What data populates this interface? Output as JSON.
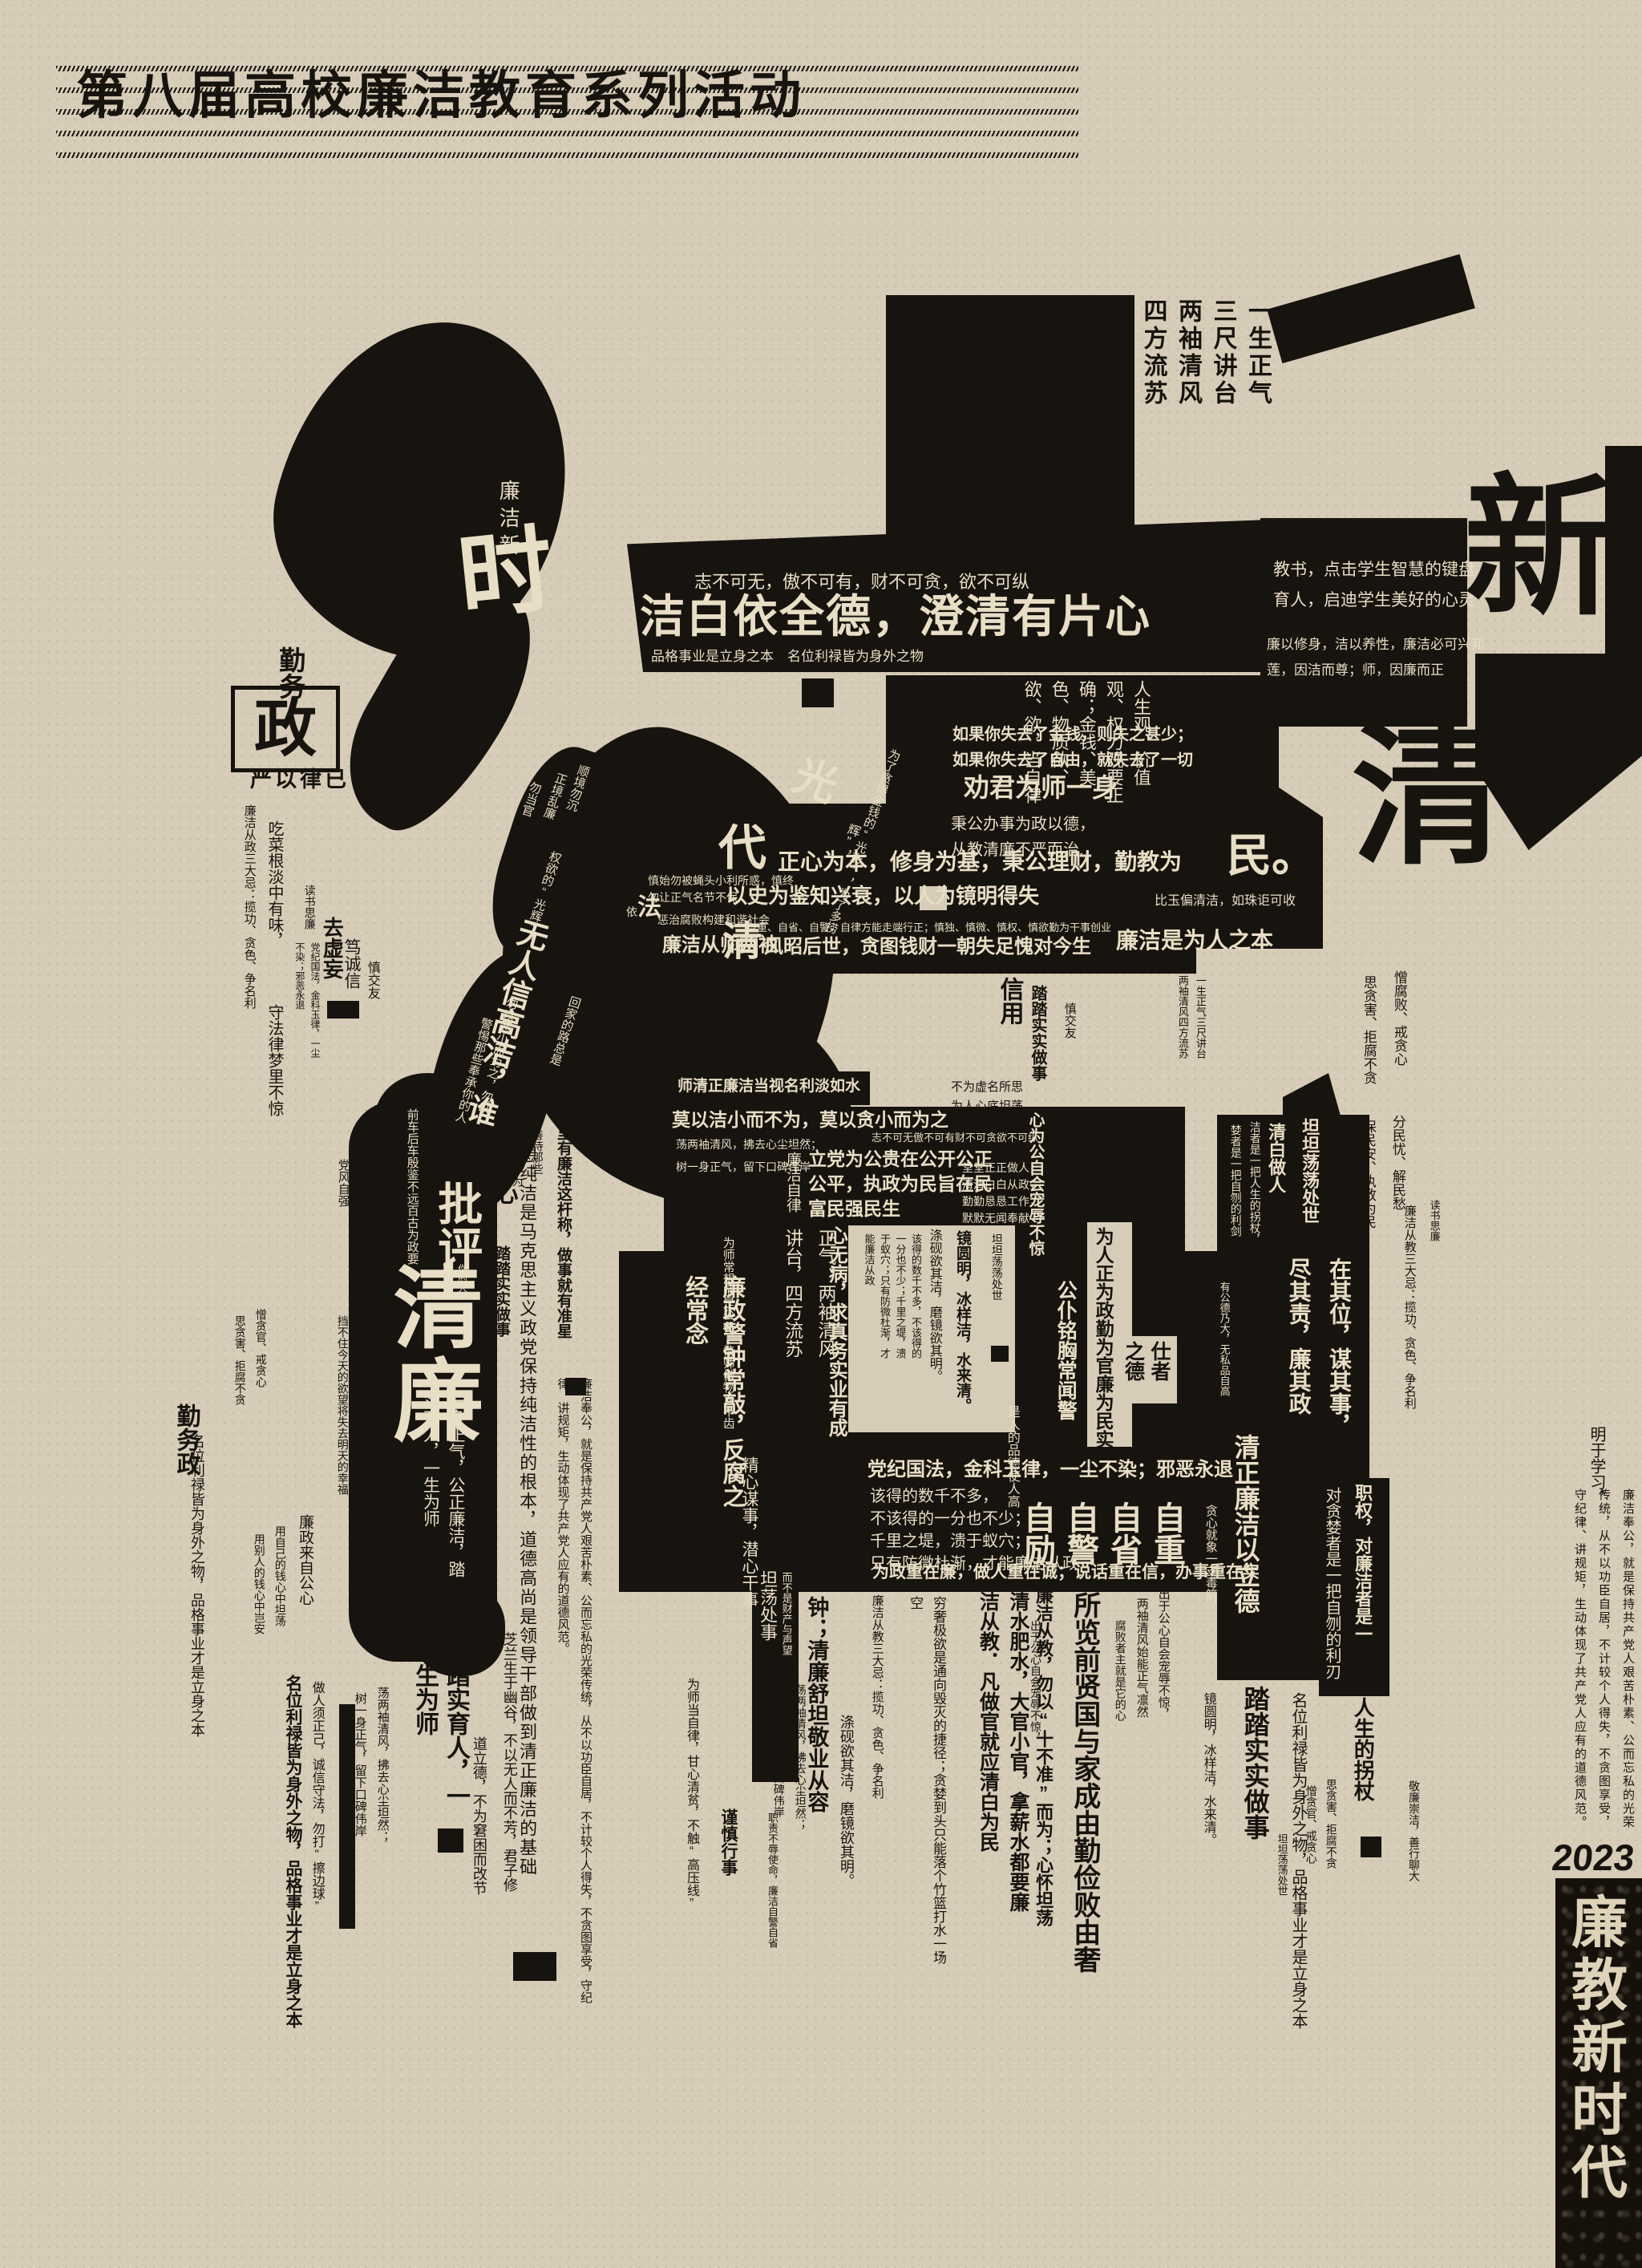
{
  "palette": {
    "paper": "#d6ccb7",
    "ink": "#17130e",
    "cream": "#e8dec5"
  },
  "title": "第八届高校廉洁教育系列活动",
  "banner": {
    "year": "2023",
    "slogan": "廉教新时代"
  },
  "texts": {
    "lianjiexin": "廉洁新",
    "shi_char": "时",
    "qinwu": "勤务",
    "zheng_char": "政",
    "yanyi": "严以律已",
    "sandaji_zheng": "廉洁从政三大忌：揽功、贪色、争名利",
    "chicai": "吃菜根淡中有味，",
    "shoufa": "守法律梦里不惊",
    "dushu": "读书思廉",
    "dangji_guofa": "党纪国法，金科玉律，一尘不染；邪恶永退",
    "quxuwang": "去虚妄",
    "duchengxin": "笃诚信",
    "shenjiaoyou": "慎交友",
    "cross_cols": "一生正气三尺讲台两袖清风四方流苏",
    "zhibuke": "志不可无，傲不可有，财不可贪，欲不可纵",
    "jiebai": "洁白依全德，澄清有片心",
    "pinge": "品格事业是立身之本　名位利禄皆为身外之物",
    "jiaoshu": "教书，点击学生智慧的键盘\n育人，启迪学生美好的心灵",
    "lianyi": "廉以修身，洁以养性，廉洁必可兴邦\n莲，因洁而尊；师，因廉而正",
    "xin_char": "新",
    "sanguan": "人生观、价值观、权力观要正确；金钱、美色、物质欲、欲、欲，当自律",
    "shiqu": "如果你失去了金钱，则失之甚少；\n如果你失去了自由，就失去了一切",
    "quanjun": "劝君为师一身",
    "binggong": "秉公办事为政以德，\n从教清廉不严而治.",
    "qing_big": "清",
    "dai_char": "代",
    "shenshi": "慎始勿被蝇头小利所惑，慎终\n勿让正气名节不保",
    "yi_char": "依",
    "fa_char": "法",
    "chengzhi": "惩治腐败构建和谐社会",
    "zhengxin": "正心为本，修身为基，秉公理财，勤教为",
    "min_char": "民。",
    "yishi": "以史为鉴知兴衰，以人为镜明得失",
    "biyu": "比玉偏清洁，如珠讵可收",
    "zizhong_zou": "自重、自省、自警、自律方能走端行正；慎独、慎微、慎权、慎欲勤为干事创业",
    "lianjie_congshi": "廉洁从师两袖",
    "qing_mid": "清",
    "fengzhao": "风昭后世，贪图钱财一朝失足愧对今生",
    "lianjie_weiren": "廉洁是为人之本",
    "xinyong": "信用",
    "tata": "踏踏实实做事",
    "xiushen": "修身敬业",
    "wei_char": "为",
    "shiqing_strip": "师清正廉洁当视名利淡如水",
    "buwei_xuming": "不为虚名所思\n为人心底坦荡",
    "xinweigong": "心为公自会宠辱不惊",
    "moyi": "莫以洁小而不为，莫以贪小而为之",
    "zhibuke2": "志不可无傲不可有财不可贪欲不可纵",
    "dang_liangxiu": "荡两袖清风，拂去心尘坦然；",
    "shu_yishen": "树一身正气，留下口碑伟岸",
    "lianjie_zilv": "廉洁自律",
    "lidang": "立党为公贵在公开公正\n公平，执政为民旨在民\n富民强民生",
    "tangtang": "堂堂正正做人，\n清清白白从政，\n勤勤恳恳工作，\n默默无闻奉献",
    "wuren": "无人信高洁，谁",
    "weibiao": "为表予心",
    "guang_char": "光",
    "hui_frag": "辉”，",
    "weiliao": "为了贪得金钱的“光彩”，为了多捞",
    "quanyu": "权欲的“光辉”，",
    "huijia": "回家的路总是",
    "shunjing": "顺境勿沉",
    "zhengjing": "正境乱廉",
    "wudangguan": "勿当官",
    "wuyie": "勿以恶小而为之，勿以",
    "jingti": "警惕那些奉承你的人",
    "wuyishan": "勿以善小而不为",
    "shandai": "善待那些",
    "qianche": "前车后车殷鉴不远百古为政要",
    "piping": "批评",
    "nideren": "你的人",
    "qinglian_big": "清廉",
    "yishen_zhengqi": "一身正气，公正廉洁，踏实育人，一生为师",
    "dangfeng": "党风自强",
    "renren": "人人廉政腐败灭亡；人人欲虽不可去，求应有所节",
    "dangbuzhu": "挡不住今天的欲望将失去明天的幸福",
    "xinli": "心里有廉洁这杆称，做事就有准星",
    "sixiang": "思想纯洁是马克思主义政党保持纯洁性的根本，道德高尚是领导干部做到清正廉洁的基础",
    "lianjie_fenggong": "廉洁奉公，就是保持共产党人艰苦朴素、公而忘私的光荣传统，从不以功臣自居，不计较个人得失，不贪图享受，守纪律、讲规矩，生动体现了共产党人应有的道德风范。",
    "qinwuzheng": "勤务政",
    "zengtan": "憎贪官、戒贪心",
    "sitanhai": "思贪害、拒腐不贪",
    "mingwei_long": "名位利禄皆为身外之物，品格事业才是立身之本",
    "lianzheng_gongxin": "廉政来自公心",
    "yongziji": "用自己的钱心中坦荡",
    "yongbieren": "用别人的钱心中岂安",
    "zuoren": "做人须正己，诚信守法，勿打“擦边球”",
    "tashi_yuren": "踏实育人，一生为师",
    "zhilan": "芝兰生于幽谷，不以无人而不芳，君子修",
    "daolide": "道立德，不为窘困而改节",
    "weishi_zilv": "为师当自律，甘心清贫，不触“高压线”",
    "shichang": "为师常想师是公仆，恃师傲物人不齿",
    "lianzheng_jing": "廉政警钟常敲，反腐之经常念",
    "zhengqi_cols": "正气，两袖清风　讲台，四方流苏",
    "xinwubing": "心无病，求真务实业有成",
    "gongpu": "公仆铭胸常闻警",
    "zhong_qinglian": "钟；清廉舒坦敬业从容",
    "erbushi": "而不是财产与声望",
    "shirenpin": "是人的品德使人高",
    "jingxin": "精心谋事，潜心干事",
    "gaide_v": "该得的数千不多，不该得的一分也不少；千里之堤，溃于蚁穴；只有防微杜渐，才能廉洁从政",
    "gaide_l": "该得的数千不多，\n不该得的一分也不少；\n千里之堤，溃于蚁穴；\n只有防微杜渐，才能廉洁从政",
    "diyan": "涤砚欲其洁，磨镜欲其明。",
    "jingyuan": "镜圆明，冰样洁，水来清。",
    "tantan": "坦坦荡荡处世",
    "weizheng_zhong": "为政重在廉，做人重在诚；说话重在信，办事重在实",
    "zizhong4": "自重　自省　自警　自励",
    "tanxin": "贪心就象一支毒箭，",
    "fubaizhe": "腐败者主就是它的心",
    "weiren_zheng": "为人正为政勤为官廉为民实",
    "shizhe": "仕者之德",
    "tandang": "坦荡处事",
    "jinshen": "谨慎行事",
    "zhize": "职责不辱使命，廉洁自警自省",
    "zaiqiwei": "在其位，谋其事，尽其责，廉其政",
    "qingzheng_lide": "清正廉洁以立德",
    "yougong": "有公德乃大，无私品自高",
    "qingbai": "清白做人",
    "jie_tail": "洁者是一把人生的拐杖，",
    "lan_tail": "婪者是一把自刎的利剑",
    "mingyu": "明于学习，",
    "zengfubai": "憎腐败、戒贪心",
    "fenminyou": "分民忧、解民愁",
    "baominan": "保民安、执教为民",
    "sandaji_jiao": "廉洁从教三大忌：揽功、贪色、争名利",
    "zhiquan": "职权，对廉洁者是一",
    "duitanlan": "对贪婪者是一把自刎的利刃",
    "rensheng_guai": "人生的拐杖",
    "jinglian_chong": "敬廉崇洁，善行聊大",
    "qiongshe": "穷奢极欲是通向毁灭的捷径；贪婪到头只能落个竹篮打水一场空",
    "qingshui": "清水肥水，大官小官，拿薪水都要廉洁从教．凡做官就应清白为民",
    "chuyu": "出于公心自会宠辱不惊，",
    "liangxiu_shineng": "两袖清风始能正气凛然",
    "lianjie_shibuzhun": "廉洁从教，勿以“十不准”而为；心怀坦荡",
    "suolan": "所览前贤国与家成由勤俭败由奢"
  }
}
